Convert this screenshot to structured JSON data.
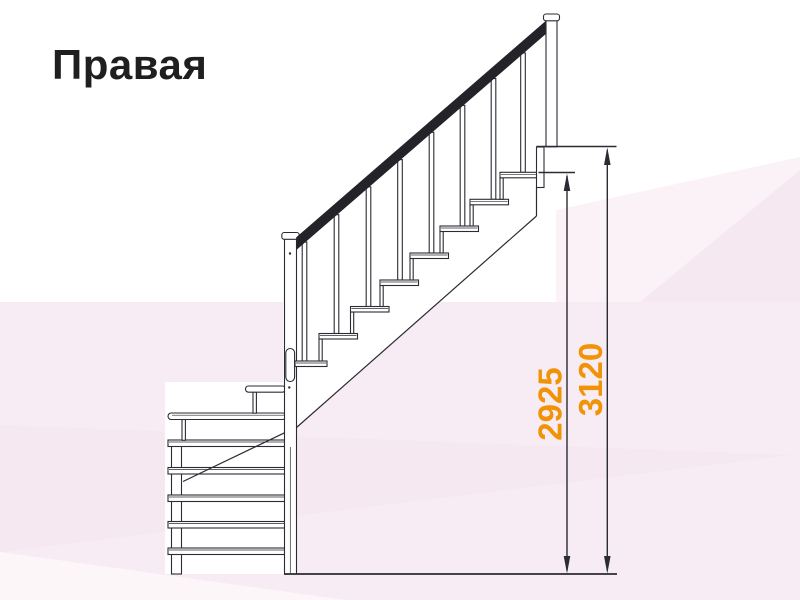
{
  "title": "Правая",
  "diagram_type": "staircase-side-view-with-dimensions",
  "dimensions": {
    "d2925": "2925",
    "d3120": "3120"
  },
  "colors": {
    "accent": "#F09307",
    "line": "#2B2B33",
    "handrail": "#232329",
    "title_color": "#1F1F1F",
    "bg_base": "#FFFFFF",
    "bg_pink": "#F8ECF4",
    "bg_pink_light": "#FBF2F8",
    "bg_pink_dark": "#F5E8F1",
    "bg_pink_lighter": "#FCF6F9"
  }
}
